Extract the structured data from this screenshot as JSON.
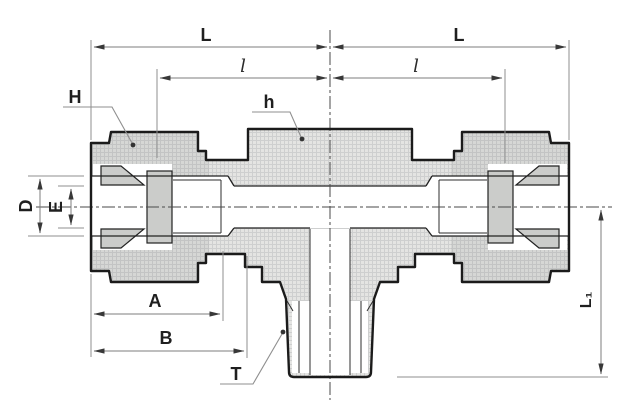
{
  "diagram": {
    "kind": "technical-drawing-cross-section",
    "labels": {
      "L_left": "L",
      "L_right": "L",
      "l_left": "l",
      "l_right": "l",
      "H": "H",
      "h": "h",
      "D": "D",
      "E": "E",
      "A": "A",
      "B": "B",
      "T": "T",
      "L1": "L₁"
    },
    "colors": {
      "outline": "#1b1b1b",
      "body_fill": "#e4e4e2",
      "nut_fill": "#d6d7d5",
      "ferrule_fill": "#cbccca",
      "dim_line": "#7d7d7d",
      "arrow": "#383838",
      "label_text": "#1f1f1f",
      "background": "#ffffff"
    }
  }
}
